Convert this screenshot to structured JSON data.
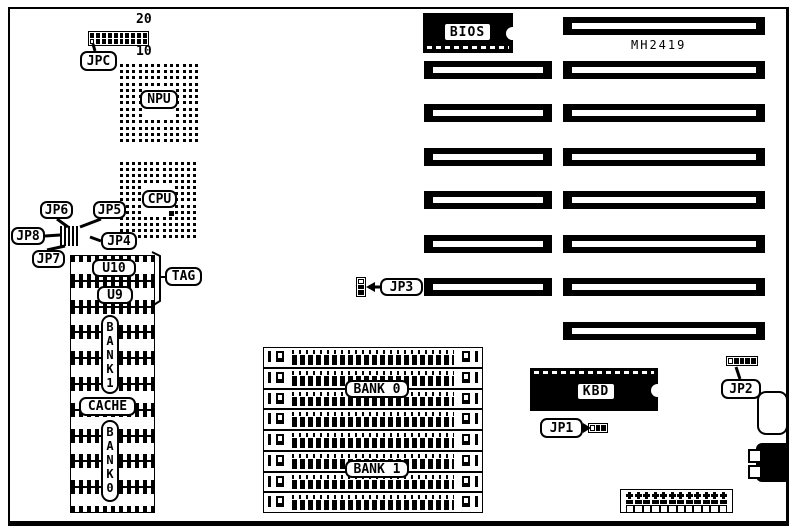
{
  "diagram": {
    "kind": "motherboard jumper location diagram",
    "board_model": "MH2419",
    "ink_color": "#000000",
    "paper_color": "#ffffff"
  },
  "sockets": {
    "npu_label": "NPU",
    "cpu_label": "CPU"
  },
  "jumpers": {
    "jpc": "JPC",
    "jpc_pin_top": "20",
    "jpc_pin_bottom": "10",
    "jp1": "JP1",
    "jp2": "JP2",
    "jp3": "JP3",
    "jp4": "JP4",
    "jp5": "JP5",
    "jp6": "JP6",
    "jp7": "JP7",
    "jp8": "JP8"
  },
  "cache_area": {
    "u10": "U10",
    "u9": "U9",
    "tag": "TAG",
    "bank1": "BANK 1",
    "cache": "CACHE",
    "bank0": "BANK 0",
    "chip_count": 10
  },
  "memory": {
    "simm_sockets": 8,
    "bank0": "BANK 0",
    "bank1": "BANK 1"
  },
  "slots": {
    "isa_long": 8,
    "isa_short": 6
  },
  "chips": {
    "bios": "BIOS",
    "kbd": "KBD",
    "model": "MH2419"
  },
  "power_connector": {
    "pins_per_row": 12
  }
}
